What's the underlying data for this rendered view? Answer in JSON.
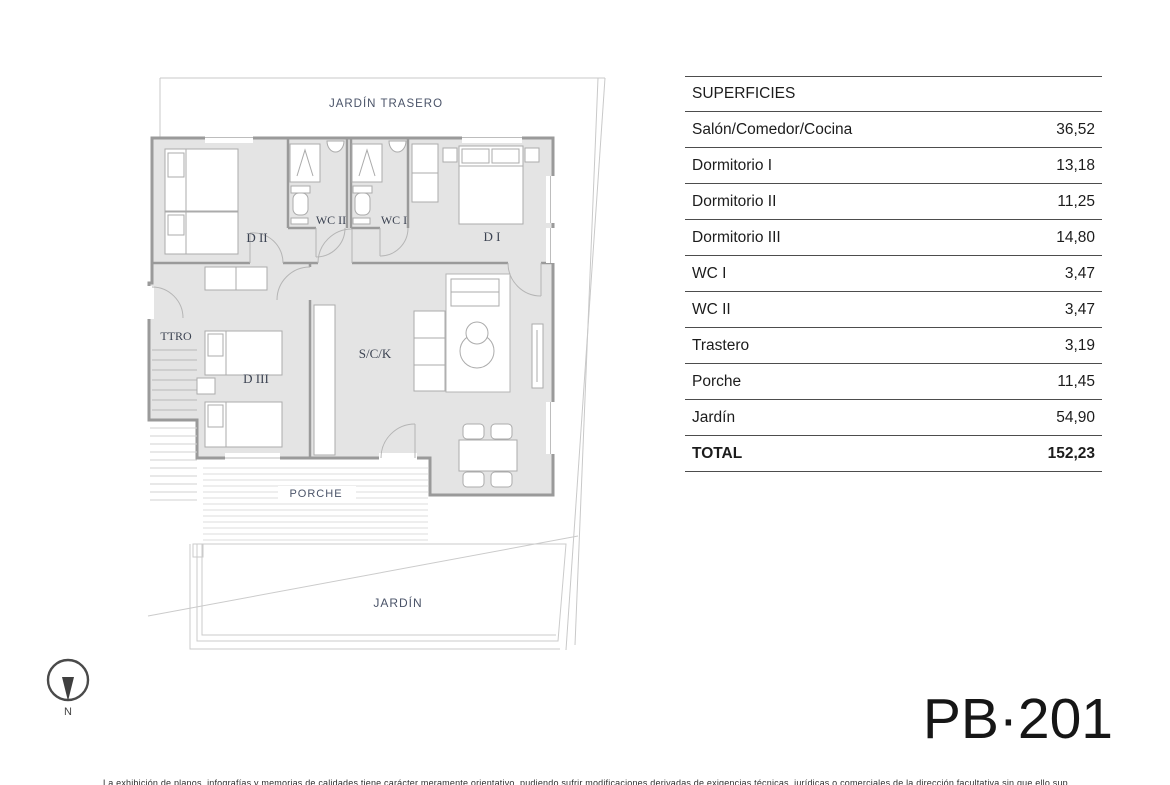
{
  "plan": {
    "labels": {
      "jardin_trasero": "JARDÍN TRASERO",
      "d2": "D II",
      "wc2": "WC II",
      "wc1": "WC I",
      "d1": "D I",
      "ttro": "TTRO",
      "d3": "D III",
      "sck": "S/C/K",
      "porche": "PORCHE",
      "jardin": "JARDÍN"
    },
    "colors": {
      "room_fill": "#e4e4e4",
      "wall": "#9a9a9a",
      "boundary": "#c9c9c9",
      "label": "#3c4352"
    }
  },
  "compass": {
    "north_label": "N"
  },
  "surfaces_table": {
    "header": "SUPERFICIES",
    "rows": [
      {
        "label": "Salón/Comedor/Cocina",
        "value": "36,52"
      },
      {
        "label": "Dormitorio I",
        "value": "13,18"
      },
      {
        "label": "Dormitorio II",
        "value": "11,25"
      },
      {
        "label": "Dormitorio III",
        "value": "14,80"
      },
      {
        "label": "WC I",
        "value": "3,47"
      },
      {
        "label": "WC II",
        "value": "3,47"
      },
      {
        "label": "Trastero",
        "value": "3,19"
      },
      {
        "label": "Porche",
        "value": "11,45"
      },
      {
        "label": "Jardín",
        "value": "54,90"
      }
    ],
    "total": {
      "label": "TOTAL",
      "value": "152,23"
    }
  },
  "plan_code": "PB·201",
  "footer": {
    "disclaimer": "La exhibición de planos, infografías y memorias de calidades tiene carácter meramente orientativo, pudiendo sufrir modificaciones derivadas de exigencias técnicas, jurídicas o comerciales de la dirección facultativa sin que ello suponga alteración de la calidad."
  }
}
